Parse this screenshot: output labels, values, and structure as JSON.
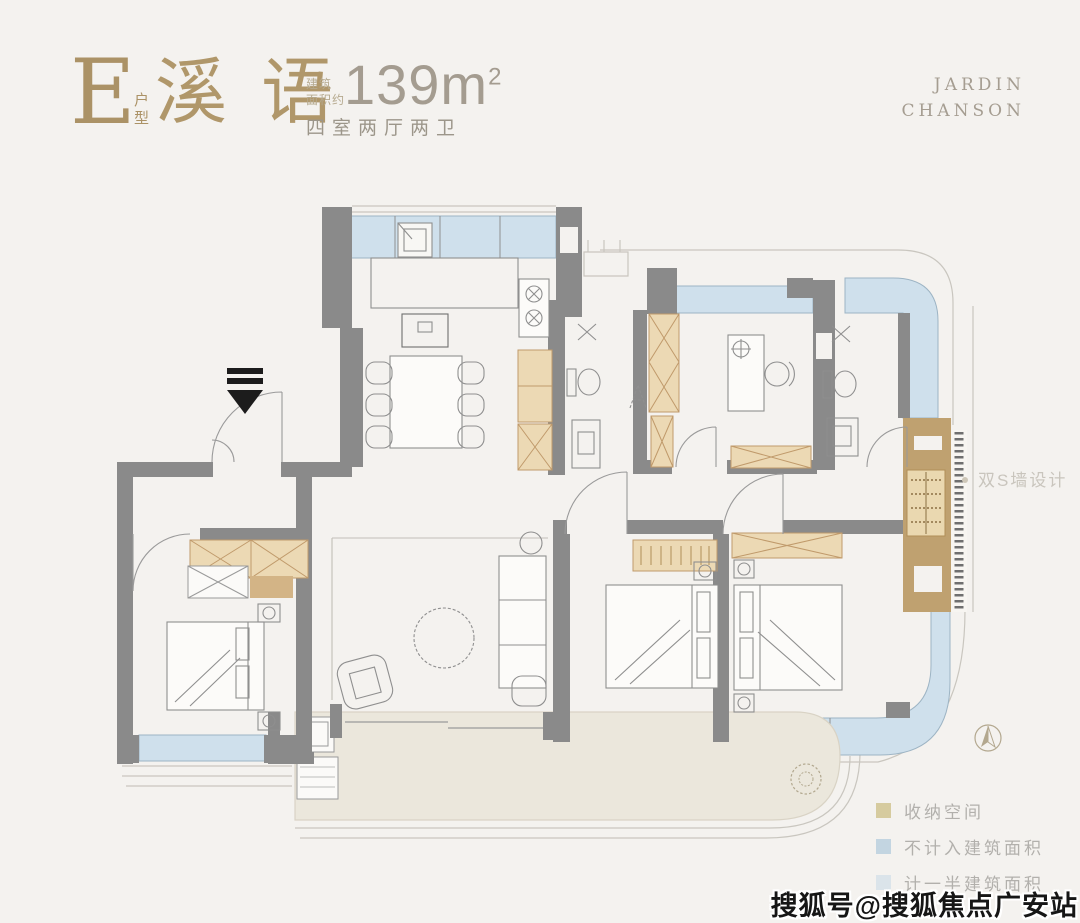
{
  "header": {
    "unit_letter": "E",
    "unit_type_label": "户型",
    "plan_name": "溪语",
    "area_label_line1": "建筑",
    "area_label_line2": "面积约",
    "area_value": "139m",
    "area_superscript": "2",
    "rooms_summary": "四室两厅两卫",
    "brand_line1": "JARDIN",
    "brand_line2": "CHANSON"
  },
  "plan": {
    "annotation_swall": "双S墙设计",
    "colors": {
      "wall_gray": "#8a8a8a",
      "balcony_blue": "#cfe0ec",
      "storage_tan": "#ecd9b4",
      "swall_brown": "#bfa170",
      "terrace_beige": "#ebe7dc",
      "accent_gold": "#b0976a"
    }
  },
  "legend": {
    "items": [
      {
        "label": "收纳空间",
        "color": "#d6cb9f"
      },
      {
        "label": "不计入建筑面积",
        "color": "#c3d5e1"
      },
      {
        "label": "计一半建筑面积",
        "color": "#dbe4ea"
      }
    ]
  },
  "watermark": "搜狐号@搜狐焦点广安站"
}
